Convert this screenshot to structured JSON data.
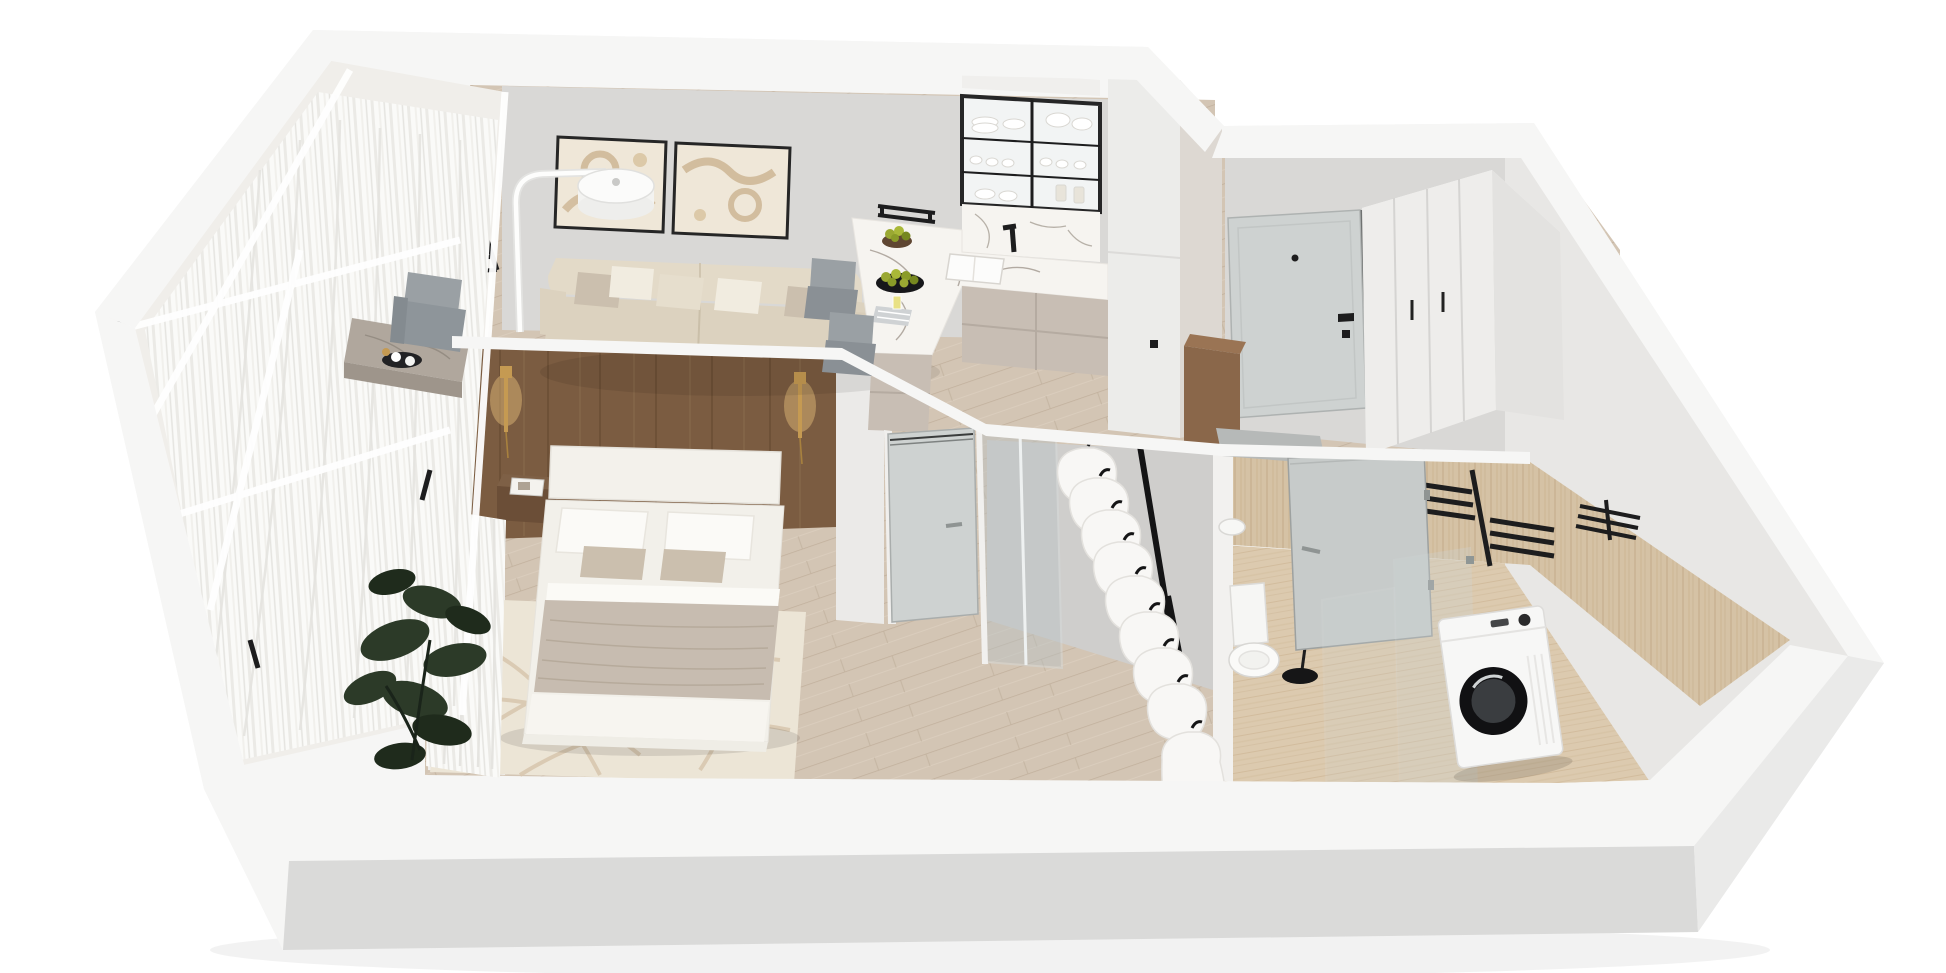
{
  "scene": {
    "kind": "isometric-3d-apartment-floor-plan-render",
    "background": "#ffffff",
    "rooms": [
      {
        "id": "balcony",
        "items": [
          "sheer-curtains",
          "glazing-frames",
          "ficus-plant",
          "marble-console-table",
          "tray-with-cups",
          "gray-armchair"
        ]
      },
      {
        "id": "living-room",
        "items": [
          "gray-feature-wall",
          "wall-bars-ladder",
          "abstract-artwork-left",
          "abstract-artwork-right",
          "arc-floor-lamp",
          "beige-sofa",
          "throw-pillows"
        ]
      },
      {
        "id": "kitchen",
        "items": [
          "glass-display-cabinet",
          "white-dishes",
          "marble-backsplash",
          "sink",
          "black-faucet",
          "marble-island",
          "pear-bowl",
          "pear-platter",
          "towel-and-glass",
          "bar-stools",
          "tall-cabinet-column",
          "lower-cabinets"
        ]
      },
      {
        "id": "entry-hall",
        "items": [
          "front-door",
          "peephole",
          "door-handle",
          "wood-bench",
          "gray-mat",
          "white-wardrobe",
          "wall-sockets"
        ]
      },
      {
        "id": "bedroom",
        "items": [
          "walnut-headboard-wall",
          "gold-sconce-left",
          "gold-sconce-right",
          "double-bed",
          "pillows",
          "taupe-duvet",
          "floating-nightstand",
          "magazine",
          "cream-rug",
          "sheer-curtain",
          "bedroom-door",
          "glass-partition"
        ]
      },
      {
        "id": "walk-in-closet",
        "items": [
          "clothes-rail",
          "white-garments-on-black-hangers"
        ]
      },
      {
        "id": "bathroom",
        "items": [
          "travertine-walls",
          "travertine-floor",
          "black-towel-rack",
          "small-towel-rack",
          "bathroom-door",
          "shower-glass",
          "washing-machine",
          "toilet",
          "pedestal-basin",
          "black-accessory"
        ]
      }
    ],
    "counts": {
      "wall_bar_rungs": 11,
      "artworks": 2,
      "garments": 9,
      "glass_cabinet_shelves": 3,
      "towel_rack_bars": 6,
      "sconces": 2,
      "bar_stools": 2
    }
  },
  "palette": {
    "wall_top": "#f6f6f5",
    "wall_white": "#efeeec",
    "wall_face": "#d9d8d6",
    "wall_face_dark": "#cfcecc",
    "wall_outer_shade": "#dadad9",
    "wall_right_shade": "#eaeae9",
    "right_inner_face": "#e8e7e5",
    "floor_wood": "#d3c5b4",
    "floor_wood_line": "#c1b09c",
    "floor_trav": "#dccaaf",
    "floor_trav_line": "#cbb391",
    "trav_wall_base": "#d5c2a5",
    "trav_wall_line": "#c2ab89",
    "wood_wall": "#7b5c41",
    "wood_wall_dark": "#64492f",
    "wood_wall_light": "#8d7051",
    "wood_bench": "#8a674a",
    "marble": "#f6f4f0",
    "marble_vein": "#8e8378",
    "cabinet_greige": "#c8beb4",
    "cabinet_greige_dark": "#b9afa5",
    "sofa_beige": "#e3dac8",
    "sofa_beige_dark": "#d8cdb9",
    "pillow_white": "#f1ece0",
    "pillow_taupe": "#cbbfae",
    "bed_white": "#f2f0ea",
    "sheet_white": "#fbfaf7",
    "duvet_taupe": "#c7bcb0",
    "rug_cream": "#ece5d6",
    "rug_line": "#d8c6ae",
    "curtain_base": "#fafaf8",
    "curtain_shade": "#e5e4e0",
    "door_gray": "#ced2d1",
    "glass_tint": "#c7d0d2",
    "black": "#1d1d1e",
    "gold": "#c59a52",
    "sconce_glow": "#e9c27c",
    "plant_green": "#2c3a28",
    "plant_dark": "#1f2b1c",
    "appliance_white": "#f7f7f6",
    "fruit_green": "#9aa832",
    "fruit_dark": "#76871f",
    "stool_gray": "#9aa0a4",
    "mat_gray": "#b6b9b8",
    "metal": "#8f9493"
  }
}
